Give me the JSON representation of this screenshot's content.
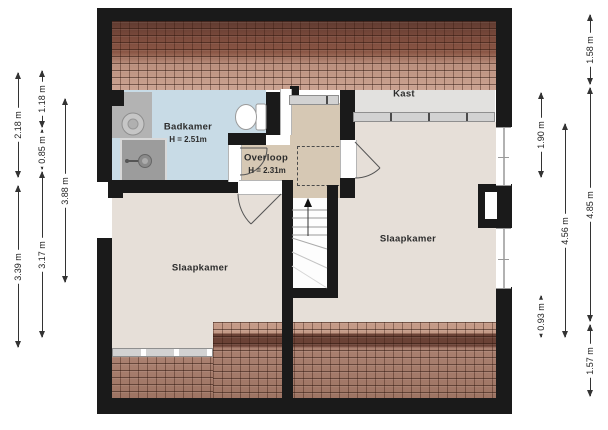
{
  "plan": {
    "type": "floorplan-attic-storey",
    "rooms": {
      "badkamer": {
        "label": "Badkamer",
        "height": "H = 2.51m"
      },
      "overloop": {
        "label": "Overloop",
        "height": "H = 2.31m"
      },
      "kast": {
        "label": "Kast"
      },
      "slaapkamer_left": {
        "label": "Slaapkamer"
      },
      "slaapkamer_right": {
        "label": "Slaapkamer"
      }
    },
    "colors": {
      "wall": "#1a1a1a",
      "badkamer_floor": "#c8dbe6",
      "overloop_floor": "#d6c8b4",
      "slaapkamer_floor": "#e6dfd8",
      "kast_floor": "#e2e1df",
      "roof_dark": "#6f4237",
      "roof_light": "#c59c8a"
    },
    "dimensions": {
      "left": [
        {
          "label": "2.18 m",
          "x": 18,
          "y1": 72,
          "y2": 178
        },
        {
          "label": "3.39 m",
          "x": 18,
          "y1": 185,
          "y2": 348
        },
        {
          "label": "1.18 m",
          "x": 42,
          "y1": 70,
          "y2": 128
        },
        {
          "label": "0.85 m",
          "x": 42,
          "y1": 129,
          "y2": 170
        },
        {
          "label": "3.17 m",
          "x": 42,
          "y1": 171,
          "y2": 338
        },
        {
          "label": "3.88 m",
          "x": 65,
          "y1": 98,
          "y2": 283
        }
      ],
      "right": [
        {
          "label": "1.90 m",
          "x": 541,
          "y1": 92,
          "y2": 178
        },
        {
          "label": "0.93 m",
          "x": 541,
          "y1": 295,
          "y2": 338
        },
        {
          "label": "4.56 m",
          "x": 565,
          "y1": 123,
          "y2": 338
        },
        {
          "label": "1.58 m",
          "x": 590,
          "y1": 14,
          "y2": 85
        },
        {
          "label": "4.85 m",
          "x": 590,
          "y1": 87,
          "y2": 322
        },
        {
          "label": "1.57 m",
          "x": 590,
          "y1": 324,
          "y2": 397
        }
      ]
    }
  }
}
